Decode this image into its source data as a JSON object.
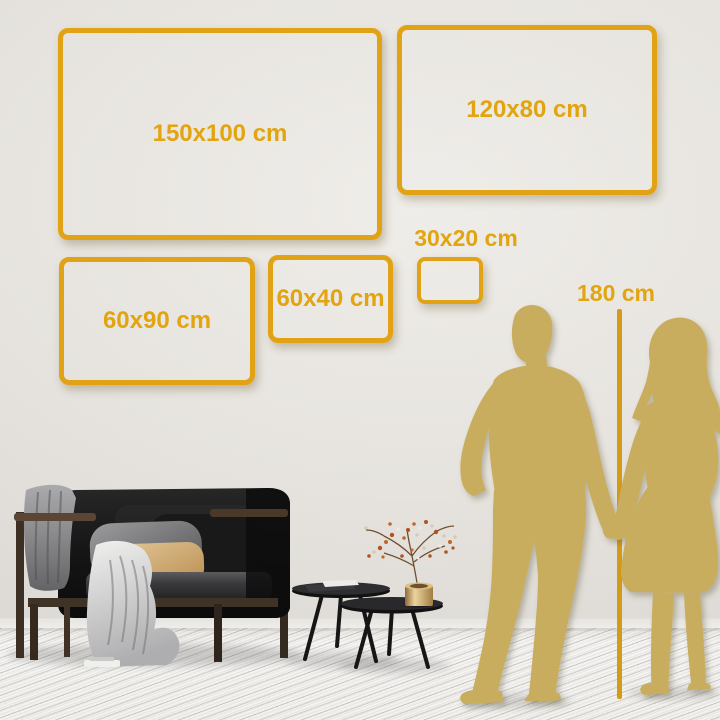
{
  "size_guide": {
    "frames": [
      {
        "id": "150x100",
        "label": "150x100 cm"
      },
      {
        "id": "120x80",
        "label": "120x80 cm"
      },
      {
        "id": "60x90",
        "label": "60x90 cm"
      },
      {
        "id": "60x40",
        "label": "60x40 cm"
      },
      {
        "id": "30x20",
        "label": "30x20 cm"
      }
    ],
    "height_reference_label": "180 cm"
  },
  "colors": {
    "frame_gold": "#e1a315",
    "label_gold": "#e2a40f",
    "measure_line_gold": "#d49b16",
    "silhouette_gold": "#c9ad5f"
  },
  "scene": {
    "people": [
      "man-silhouette",
      "woman-silhouette"
    ],
    "furniture": [
      "sofa",
      "gray-blanket",
      "throw-blanket",
      "pillow-gray",
      "pillow-tan",
      "coffee-table-large",
      "coffee-table-small",
      "books",
      "vase-with-branch"
    ]
  }
}
